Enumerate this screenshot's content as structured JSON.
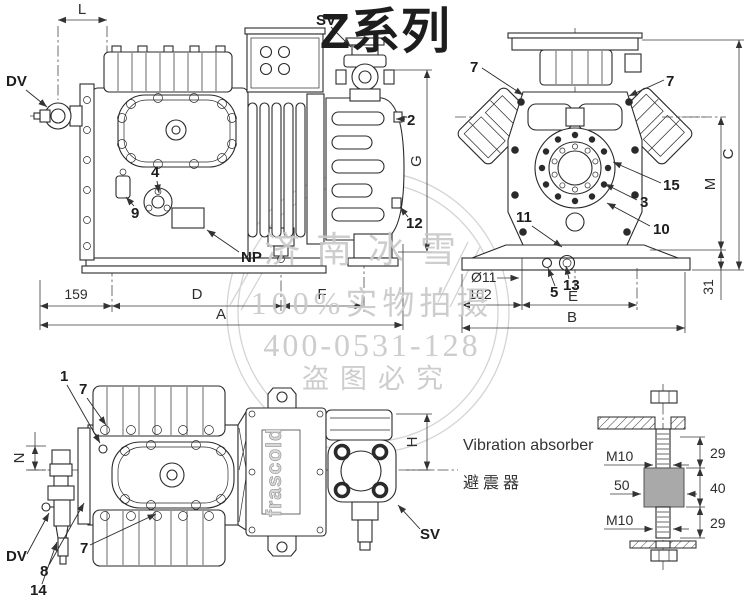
{
  "title": {
    "text": "Z系列",
    "color": "#0d5fae"
  },
  "watermark": {
    "company": "济南冰雪",
    "slogan": "100%实物拍摄",
    "phone": "400-0531-128",
    "warning": "盗图必究",
    "color": "#c9c9c9"
  },
  "brand": "frascold",
  "side_view": {
    "callouts": {
      "dv": "DV",
      "sv": "SV",
      "np": "NP",
      "c2": "2",
      "c4": "4",
      "c9": "9",
      "c12": "12"
    },
    "dims": {
      "L": "L",
      "len159": "159",
      "D": "D",
      "F": "F",
      "A": "A",
      "G": "G"
    }
  },
  "end_view": {
    "callouts": {
      "c7l": "7",
      "c7r": "7",
      "c15": "15",
      "c3": "3",
      "c10": "10",
      "c11": "11",
      "c5": "5",
      "c13": "13"
    },
    "dims": {
      "C": "C",
      "M": "M",
      "len31": "31",
      "dia": "Ø11",
      "len102": "102",
      "E": "E",
      "B": "B"
    }
  },
  "top_view": {
    "callouts": {
      "c1": "1",
      "c7a": "7",
      "c7b": "7",
      "c8": "8",
      "c14": "14",
      "dv": "DV",
      "sv": "SV"
    },
    "dims": {
      "N": "N",
      "H": "H"
    }
  },
  "absorber": {
    "label_en": "Vibration absorber",
    "label_zh": "避震器",
    "m10_top": "M10",
    "len50": "50",
    "m10_bot": "M10",
    "len29_top": "29",
    "len40": "40",
    "len29_bot": "29"
  }
}
